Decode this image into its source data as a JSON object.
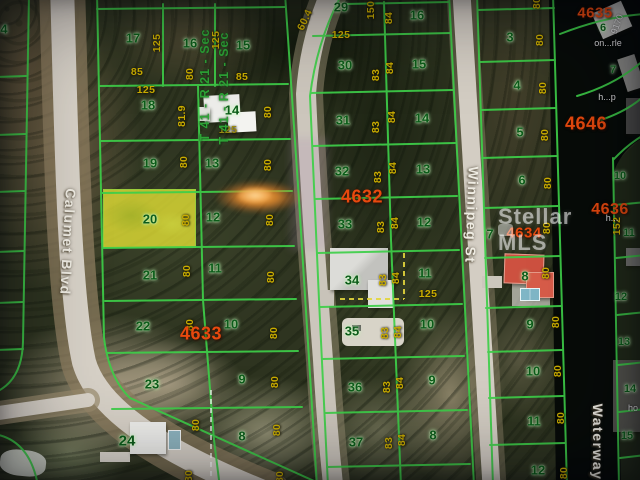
{
  "map": {
    "watermark": {
      "text": "Stellar MLS"
    },
    "colors": {
      "grid_line_green": "#3ecf49",
      "lot_number_green": "#0d5c1a",
      "dimension_yellow": "#c9ac00",
      "block_number_red": "#e8490e",
      "highlight_lot_yellow": "#e2e034",
      "road_gray": "#d6d0c6",
      "water_dark": "#070b08"
    },
    "labels": {
      "streets": [
        {
          "t": "Calumet Blvd",
          "x": 68,
          "y": 242,
          "r": 93
        },
        {
          "t": "Winnipeg St",
          "x": 472,
          "y": 215,
          "r": 92
        },
        {
          "t": "Waterway",
          "x": 598,
          "y": 442,
          "r": 90
        }
      ],
      "sections": [
        {
          "t": "T 41 - R 21 - Sec",
          "x": 205,
          "y": 85,
          "r": -90
        },
        {
          "t": "T 41 - R 21 - Sec",
          "x": 224,
          "y": 88,
          "r": -90
        }
      ],
      "blocks": [
        {
          "t": "4632",
          "x": 362,
          "y": 197,
          "fs": 18
        },
        {
          "t": "4633",
          "x": 201,
          "y": 334,
          "fs": 18
        },
        {
          "t": "4634",
          "x": 524,
          "y": 233,
          "fs": 15
        },
        {
          "t": "4635",
          "x": 595,
          "y": 13,
          "fs": 15
        },
        {
          "t": "4646",
          "x": 586,
          "y": 124,
          "fs": 18
        },
        {
          "t": "4636",
          "x": 610,
          "y": 210,
          "fs": 16
        }
      ],
      "lots": [
        {
          "t": "4",
          "x": 4,
          "y": 29
        },
        {
          "t": "17",
          "x": 133,
          "y": 38
        },
        {
          "t": "16",
          "x": 190,
          "y": 43
        },
        {
          "t": "15",
          "x": 243,
          "y": 45
        },
        {
          "t": "18",
          "x": 148,
          "y": 105
        },
        {
          "t": "14",
          "x": 232,
          "y": 110
        },
        {
          "t": "19",
          "x": 150,
          "y": 163
        },
        {
          "t": "13",
          "x": 212,
          "y": 163
        },
        {
          "t": "20",
          "x": 150,
          "y": 219,
          "hl": true
        },
        {
          "t": "12",
          "x": 213,
          "y": 217
        },
        {
          "t": "21",
          "x": 150,
          "y": 275
        },
        {
          "t": "11",
          "x": 215,
          "y": 268
        },
        {
          "t": "22",
          "x": 143,
          "y": 326
        },
        {
          "t": "10",
          "x": 231,
          "y": 324
        },
        {
          "t": "23",
          "x": 152,
          "y": 384
        },
        {
          "t": "9",
          "x": 242,
          "y": 379
        },
        {
          "t": "24",
          "x": 127,
          "y": 441,
          "fs": 15
        },
        {
          "t": "8",
          "x": 242,
          "y": 436
        },
        {
          "t": "29",
          "x": 341,
          "y": 7
        },
        {
          "t": "16",
          "x": 417,
          "y": 15
        },
        {
          "t": "30",
          "x": 345,
          "y": 65
        },
        {
          "t": "15",
          "x": 419,
          "y": 64
        },
        {
          "t": "31",
          "x": 343,
          "y": 120
        },
        {
          "t": "14",
          "x": 422,
          "y": 118
        },
        {
          "t": "32",
          "x": 342,
          "y": 171
        },
        {
          "t": "13",
          "x": 423,
          "y": 169
        },
        {
          "t": "33",
          "x": 345,
          "y": 224
        },
        {
          "t": "12",
          "x": 424,
          "y": 222
        },
        {
          "t": "34",
          "x": 352,
          "y": 280
        },
        {
          "t": "11",
          "x": 425,
          "y": 273
        },
        {
          "t": "35",
          "x": 352,
          "y": 331
        },
        {
          "t": "10",
          "x": 427,
          "y": 324
        },
        {
          "t": "36",
          "x": 355,
          "y": 387
        },
        {
          "t": "9",
          "x": 432,
          "y": 380
        },
        {
          "t": "37",
          "x": 356,
          "y": 442
        },
        {
          "t": "8",
          "x": 433,
          "y": 435
        },
        {
          "t": "3",
          "x": 510,
          "y": 37
        },
        {
          "t": "4",
          "x": 517,
          "y": 85
        },
        {
          "t": "5",
          "x": 520,
          "y": 132
        },
        {
          "t": "6",
          "x": 522,
          "y": 180
        },
        {
          "t": "7",
          "x": 490,
          "y": 234
        },
        {
          "t": "8",
          "x": 525,
          "y": 276
        },
        {
          "t": "9",
          "x": 530,
          "y": 324
        },
        {
          "t": "10",
          "x": 533,
          "y": 371
        },
        {
          "t": "11",
          "x": 534,
          "y": 421
        },
        {
          "t": "12",
          "x": 538,
          "y": 470
        },
        {
          "t": "6",
          "x": 603,
          "y": 28,
          "fs": 11
        },
        {
          "t": "7",
          "x": 613,
          "y": 70,
          "fs": 11
        },
        {
          "t": "10",
          "x": 620,
          "y": 176,
          "fs": 11
        },
        {
          "t": "11",
          "x": 629,
          "y": 233,
          "fs": 11
        },
        {
          "t": "12",
          "x": 621,
          "y": 297,
          "fs": 11
        },
        {
          "t": "13",
          "x": 624,
          "y": 342,
          "fs": 11
        },
        {
          "t": "14",
          "x": 630,
          "y": 389,
          "fs": 11
        },
        {
          "t": "15",
          "x": 627,
          "y": 436,
          "fs": 11
        }
      ],
      "dims": [
        {
          "t": "125",
          "x": 157,
          "y": 43,
          "r": -90
        },
        {
          "t": "85",
          "x": 137,
          "y": 72,
          "r": 0
        },
        {
          "t": "80",
          "x": 190,
          "y": 74,
          "r": -90
        },
        {
          "t": "125",
          "x": 146,
          "y": 90,
          "r": 0
        },
        {
          "t": "81.9",
          "x": 182,
          "y": 116,
          "r": -90
        },
        {
          "t": "125",
          "x": 216,
          "y": 40,
          "r": -90
        },
        {
          "t": "85",
          "x": 242,
          "y": 77,
          "r": 0
        },
        {
          "t": "125",
          "x": 228,
          "y": 130,
          "r": 0,
          "c": "#9a8a10"
        },
        {
          "t": "80",
          "x": 268,
          "y": 112,
          "r": -90
        },
        {
          "t": "80",
          "x": 184,
          "y": 162,
          "r": -90
        },
        {
          "t": "80",
          "x": 186,
          "y": 220,
          "r": -90
        },
        {
          "t": "80",
          "x": 187,
          "y": 271,
          "r": -90
        },
        {
          "t": "80",
          "x": 190,
          "y": 325,
          "r": -90
        },
        {
          "t": "80",
          "x": 196,
          "y": 425,
          "r": -90
        },
        {
          "t": "80",
          "x": 189,
          "y": 476,
          "r": -90
        },
        {
          "t": "80",
          "x": 268,
          "y": 165,
          "r": -90
        },
        {
          "t": "80",
          "x": 270,
          "y": 220,
          "r": -90
        },
        {
          "t": "80",
          "x": 271,
          "y": 277,
          "r": -90
        },
        {
          "t": "80",
          "x": 274,
          "y": 333,
          "r": -90
        },
        {
          "t": "80",
          "x": 275,
          "y": 382,
          "r": -90
        },
        {
          "t": "80",
          "x": 277,
          "y": 430,
          "r": -90
        },
        {
          "t": "80",
          "x": 280,
          "y": 477,
          "r": -90
        },
        {
          "t": "60.4",
          "x": 305,
          "y": 20,
          "r": -65
        },
        {
          "t": "150",
          "x": 371,
          "y": 10,
          "r": -90
        },
        {
          "t": "125",
          "x": 341,
          "y": 35,
          "r": 0
        },
        {
          "t": "83",
          "x": 376,
          "y": 75,
          "r": -90
        },
        {
          "t": "83",
          "x": 376,
          "y": 127,
          "r": -90
        },
        {
          "t": "83",
          "x": 378,
          "y": 177,
          "r": -90
        },
        {
          "t": "83",
          "x": 381,
          "y": 227,
          "r": -90
        },
        {
          "t": "83",
          "x": 383,
          "y": 280,
          "r": -90
        },
        {
          "t": "83",
          "x": 385,
          "y": 333,
          "r": -90
        },
        {
          "t": "83",
          "x": 387,
          "y": 387,
          "r": -90
        },
        {
          "t": "83",
          "x": 389,
          "y": 443,
          "r": -90
        },
        {
          "t": "84",
          "x": 389,
          "y": 18,
          "r": -90
        },
        {
          "t": "84",
          "x": 390,
          "y": 68,
          "r": -90
        },
        {
          "t": "84",
          "x": 392,
          "y": 117,
          "r": -90
        },
        {
          "t": "84",
          "x": 393,
          "y": 168,
          "r": -90
        },
        {
          "t": "84",
          "x": 395,
          "y": 223,
          "r": -90
        },
        {
          "t": "84",
          "x": 396,
          "y": 278,
          "r": -90
        },
        {
          "t": "84",
          "x": 398,
          "y": 332,
          "r": -90
        },
        {
          "t": "84",
          "x": 400,
          "y": 383,
          "r": -90
        },
        {
          "t": "84",
          "x": 402,
          "y": 440,
          "r": -90
        },
        {
          "t": "125",
          "x": 428,
          "y": 294,
          "r": 0
        },
        {
          "t": "80",
          "x": 537,
          "y": 3,
          "r": -90
        },
        {
          "t": "80",
          "x": 540,
          "y": 40,
          "r": -90
        },
        {
          "t": "80",
          "x": 543,
          "y": 88,
          "r": -90
        },
        {
          "t": "80",
          "x": 545,
          "y": 135,
          "r": -90
        },
        {
          "t": "80",
          "x": 548,
          "y": 183,
          "r": -90
        },
        {
          "t": "80",
          "x": 547,
          "y": 228,
          "r": -90
        },
        {
          "t": "80",
          "x": 546,
          "y": 273,
          "r": -90
        },
        {
          "t": "80",
          "x": 556,
          "y": 322,
          "r": -90
        },
        {
          "t": "80",
          "x": 558,
          "y": 371,
          "r": -90
        },
        {
          "t": "80",
          "x": 561,
          "y": 418,
          "r": -90
        },
        {
          "t": "80",
          "x": 564,
          "y": 473,
          "r": -90
        },
        {
          "t": "152",
          "x": 617,
          "y": 226,
          "r": -90
        }
      ],
      "fragments": [
        {
          "t": "9170",
          "x": 617,
          "y": 24,
          "r": -70
        },
        {
          "t": "on...rle",
          "x": 608,
          "y": 43,
          "r": 0
        },
        {
          "t": "h...p",
          "x": 607,
          "y": 97,
          "r": 0
        },
        {
          "t": "h...",
          "x": 612,
          "y": 218,
          "r": 0
        },
        {
          "t": "ho",
          "x": 633,
          "y": 408,
          "r": 0
        }
      ]
    }
  }
}
